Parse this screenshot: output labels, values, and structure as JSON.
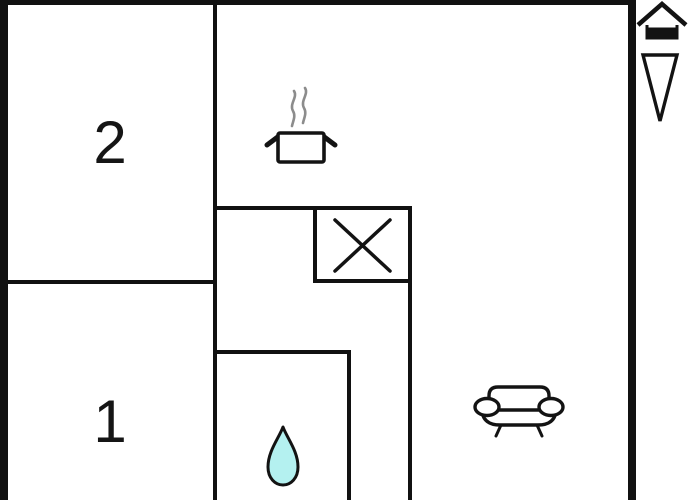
{
  "floorplan": {
    "rooms": [
      {
        "id": "room-2",
        "label": "2"
      },
      {
        "id": "room-1",
        "label": "1"
      }
    ],
    "symbols": [
      "cooking-pot-icon",
      "crossed-box-icon",
      "water-drop-icon",
      "sofa-icon"
    ],
    "legend": [
      "house-icon",
      "down-arrow-icon"
    ],
    "colors": {
      "wall": "#111111",
      "background": "#ffffff",
      "water_drop_fill": "#b4f1f0",
      "steam_stroke": "#8c8c8c",
      "line_stroke": "#131313"
    }
  }
}
